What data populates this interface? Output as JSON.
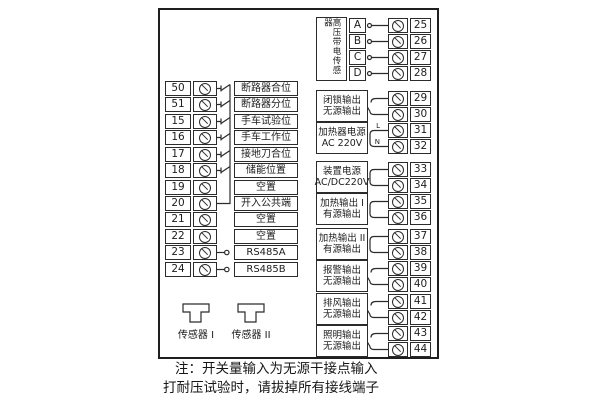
{
  "diagram": {
    "left_rows": [
      {
        "num": "50",
        "label": "断路器合位"
      },
      {
        "num": "51",
        "label": "断路器分位"
      },
      {
        "num": "15",
        "label": "手车试验位"
      },
      {
        "num": "16",
        "label": "手车工作位"
      },
      {
        "num": "17",
        "label": "接地刀合位"
      },
      {
        "num": "18",
        "label": "储能位置"
      },
      {
        "num": "19",
        "label": "空置"
      },
      {
        "num": "20",
        "label": "开入公共端"
      },
      {
        "num": "21",
        "label": "空置"
      },
      {
        "num": "22",
        "label": "空置"
      },
      {
        "num": "23",
        "label": "RS485A"
      },
      {
        "num": "24",
        "label": "RS485B"
      }
    ],
    "right": {
      "sensor_group": {
        "label": "高压带电传感器",
        "channels": [
          {
            "letter": "A",
            "num": "25"
          },
          {
            "letter": "B",
            "num": "26"
          },
          {
            "letter": "C",
            "num": "27"
          },
          {
            "letter": "D",
            "num": "28"
          }
        ]
      },
      "groups": [
        {
          "line1": "闭锁输出",
          "line2": "无源输出",
          "num_top": "29",
          "num_bottom": "30"
        },
        {
          "line1": "加热器电源",
          "line2": "AC 220V",
          "num_top": "31",
          "num_bottom": "32",
          "wire_top": "L",
          "wire_bottom": "N"
        },
        {
          "line1": "装置电源",
          "line2": "AC/DC220V",
          "num_top": "33",
          "num_bottom": "34"
        },
        {
          "line1": "加热输出 I",
          "line2": "有源输出",
          "num_top": "35",
          "num_bottom": "36"
        },
        {
          "line1": "加热输出 II",
          "line2": "有源输出",
          "num_top": "37",
          "num_bottom": "38"
        },
        {
          "line1": "报警输出",
          "line2": "无源输出",
          "num_top": "39",
          "num_bottom": "40"
        },
        {
          "line1": "排风输出",
          "line2": "无源输出",
          "num_top": "41",
          "num_bottom": "42"
        },
        {
          "line1": "照明输出",
          "line2": "无源输出",
          "num_top": "43",
          "num_bottom": "44"
        }
      ]
    },
    "sensors": [
      {
        "label": "传感器 I"
      },
      {
        "label": "传感器 II"
      }
    ],
    "note": {
      "line1": "注：开关量输入为无源干接点输入",
      "line2": "打耐压试验时，请拔掉所有接线端子"
    }
  }
}
